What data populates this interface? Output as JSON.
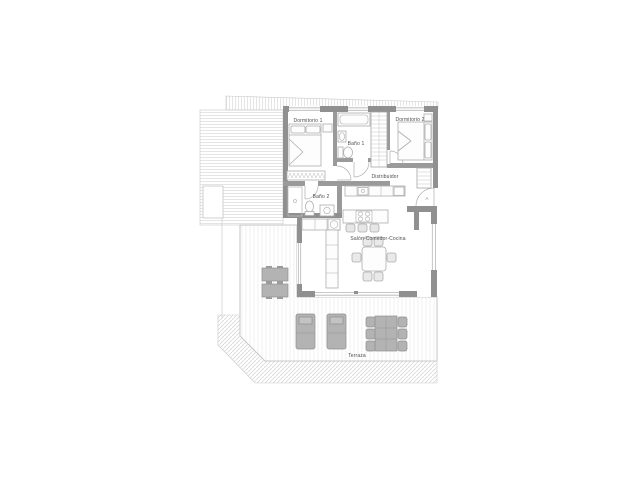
{
  "floorplan": {
    "room_labels": {
      "dormitorio1": "Dormitorio 1",
      "bano1": "Baño 1",
      "dormitorio2": "Dormitorio 2",
      "distribuidor": "Distribuidor",
      "bano2": "Baño 2",
      "salon_comedor_cocina": "Salón-Comedor-Cocina",
      "terraza": "Terraza"
    },
    "entrance_door_label": "A",
    "colors": {
      "exterior_wall": "#909090",
      "interior_wall": "#9a9a9a",
      "furniture_line": "#adadad",
      "outdoor_furniture_fill": "#b3b3b3",
      "roof_hatch_line": "#dadada",
      "deck_hatch_line": "#ededed",
      "label_text": "#4d4d4d",
      "background": "#ffffff"
    }
  }
}
